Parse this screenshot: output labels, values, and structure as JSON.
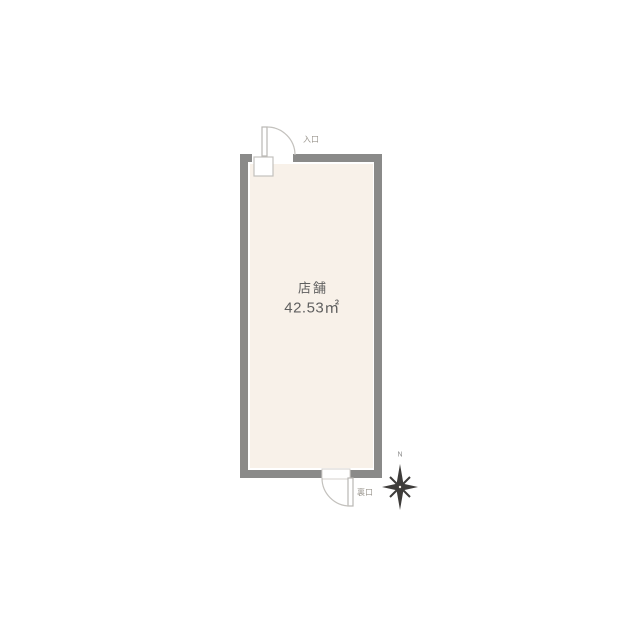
{
  "colors": {
    "wall": "#8a8a89",
    "floor": "#f8f1e9",
    "door_line": "#b9b7b3",
    "room_text": "#5f5f5f",
    "door_text": "#9b978f",
    "compass": "#3e3c3a"
  },
  "floorplan": {
    "room": {
      "name": "店舗",
      "area": "42.53㎡"
    },
    "doors": [
      {
        "label": "入口",
        "position": "top-left"
      },
      {
        "label": "裏口",
        "position": "bottom-right"
      }
    ],
    "compass": {
      "north_label": "N"
    }
  }
}
